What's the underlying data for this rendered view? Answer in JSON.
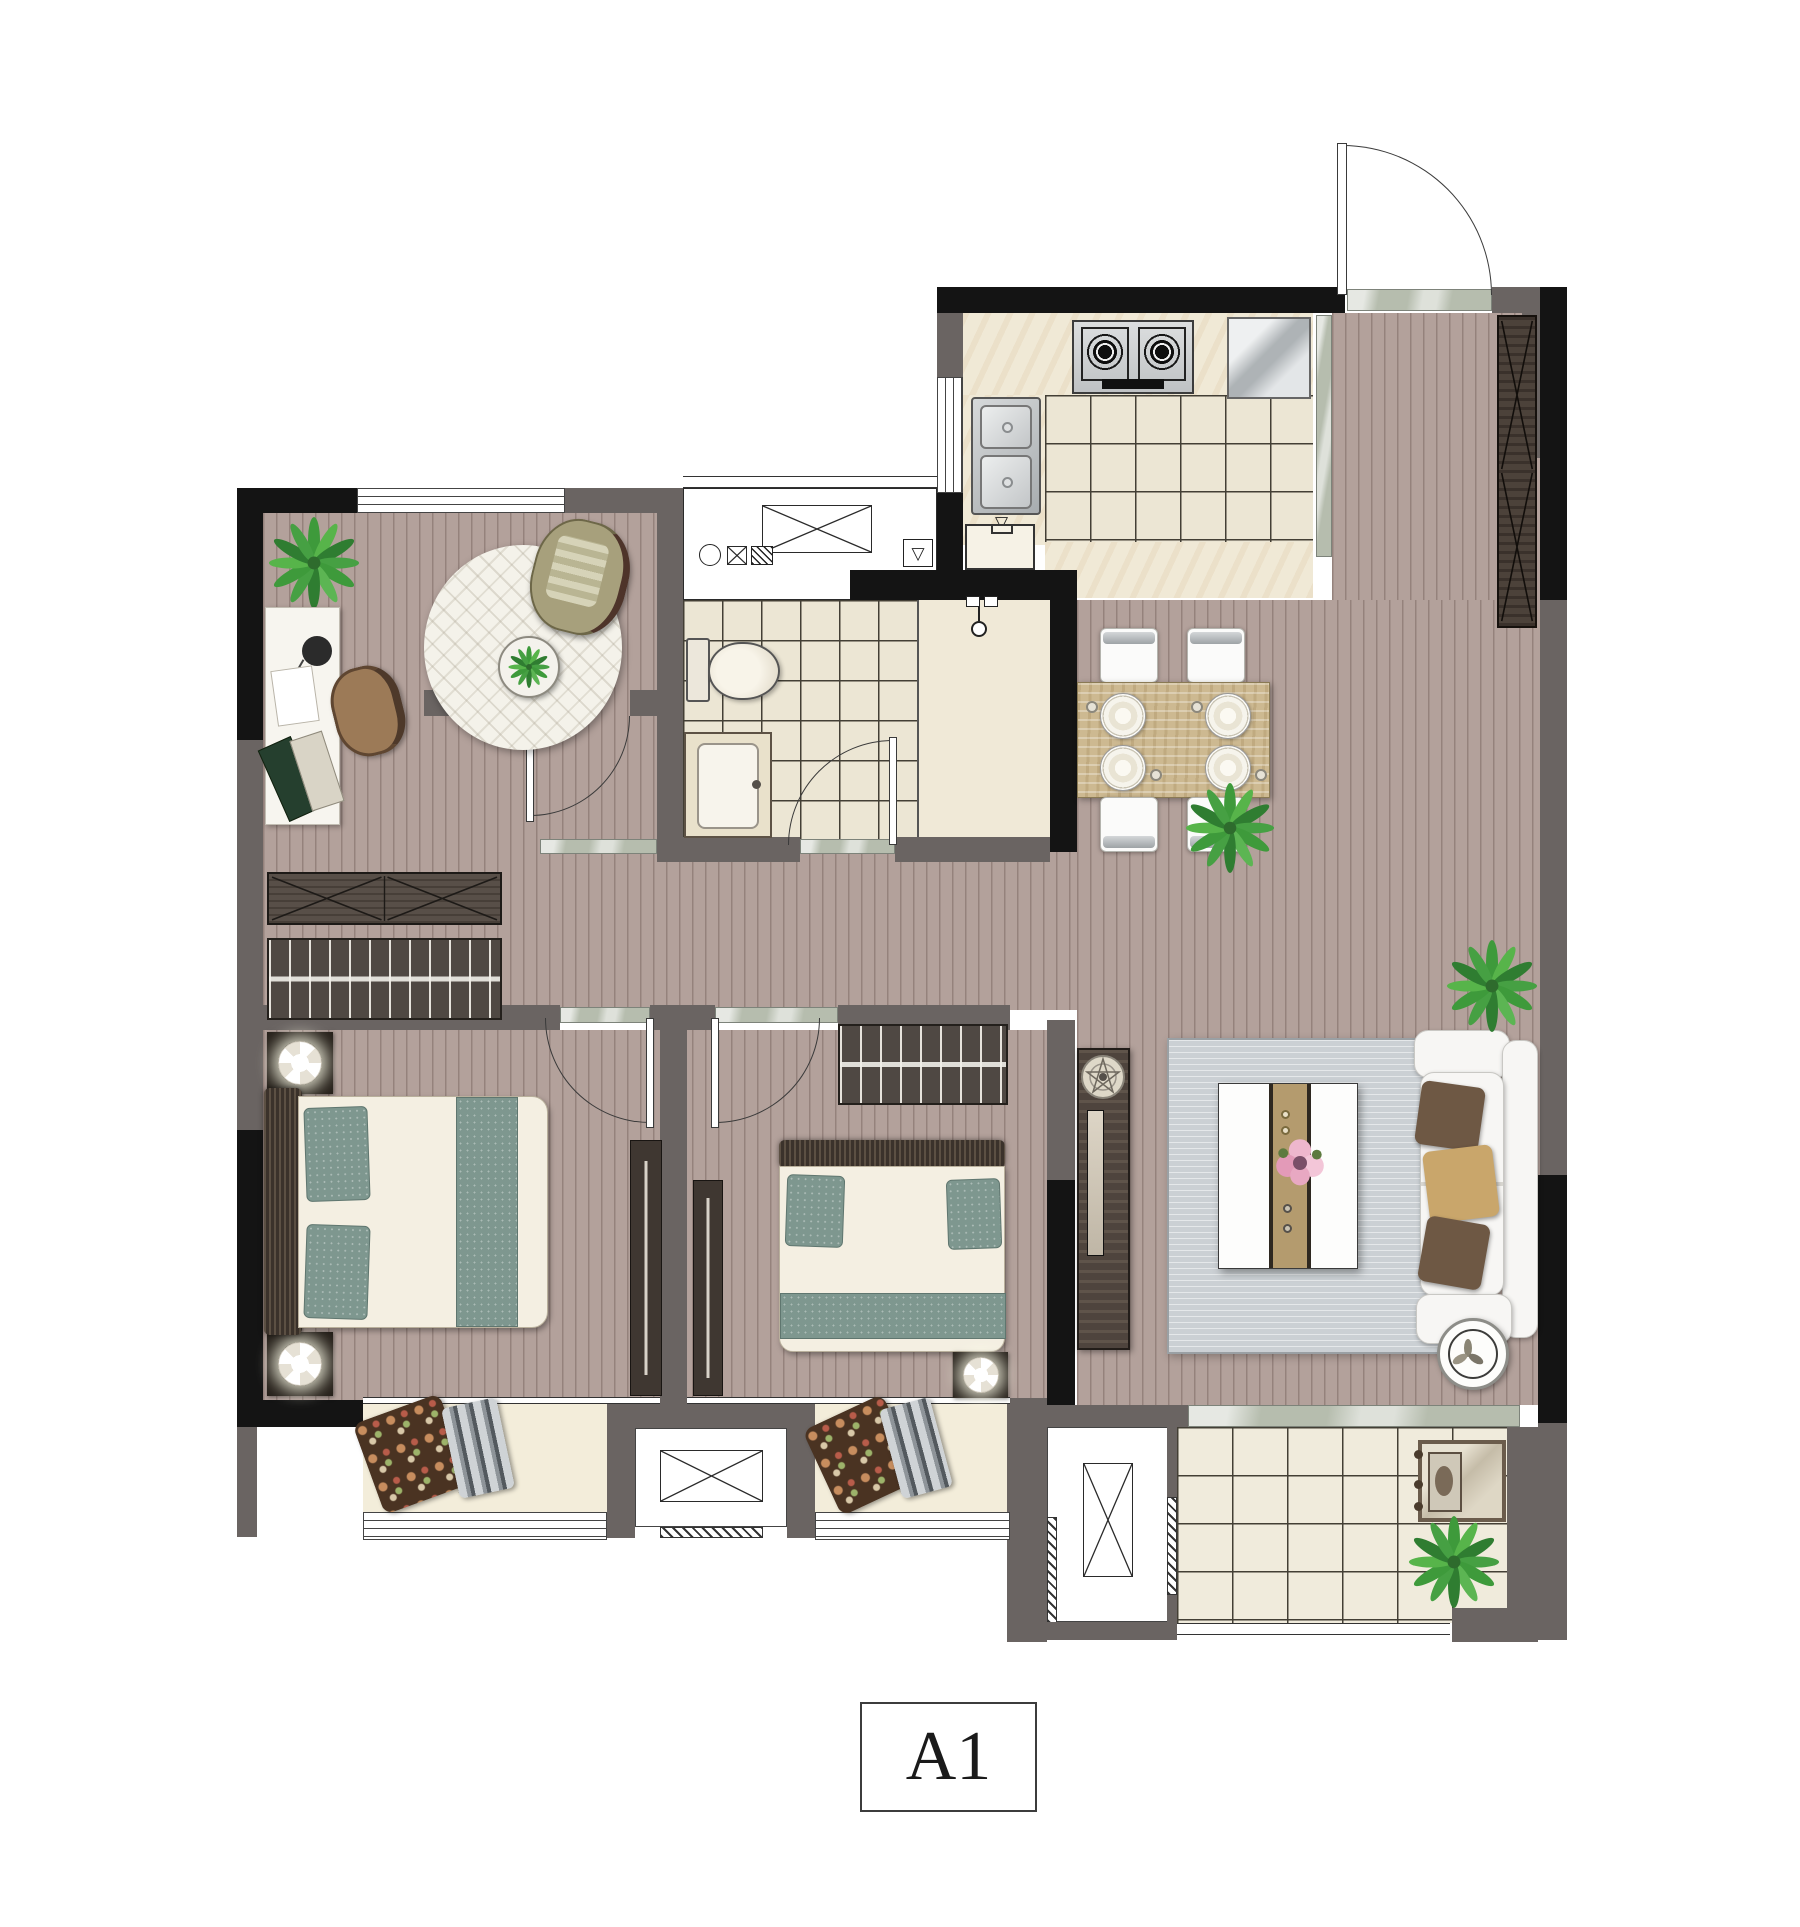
{
  "unit_label": {
    "text": "A1"
  },
  "symbols": {
    "floor_drain_glyph": "▽"
  },
  "palette": {
    "wall_dark": "#141414",
    "wall_gray": "#6a6462",
    "floor_wood": "#b3a19b",
    "floor_tile": "#ece6d4",
    "floor_marble": "#f3edda",
    "threshold": "#b6bdae",
    "rug_living": "#cbd0d4",
    "pillow_teal": "#7e978f",
    "plant_green": "#3e9a3b",
    "sofa_white": "#f7f6f4",
    "table_wood": "#cdb991",
    "furniture_dark": "#4a423c",
    "tile_line": "#433f35",
    "arc_line": "#3a3a3a"
  }
}
